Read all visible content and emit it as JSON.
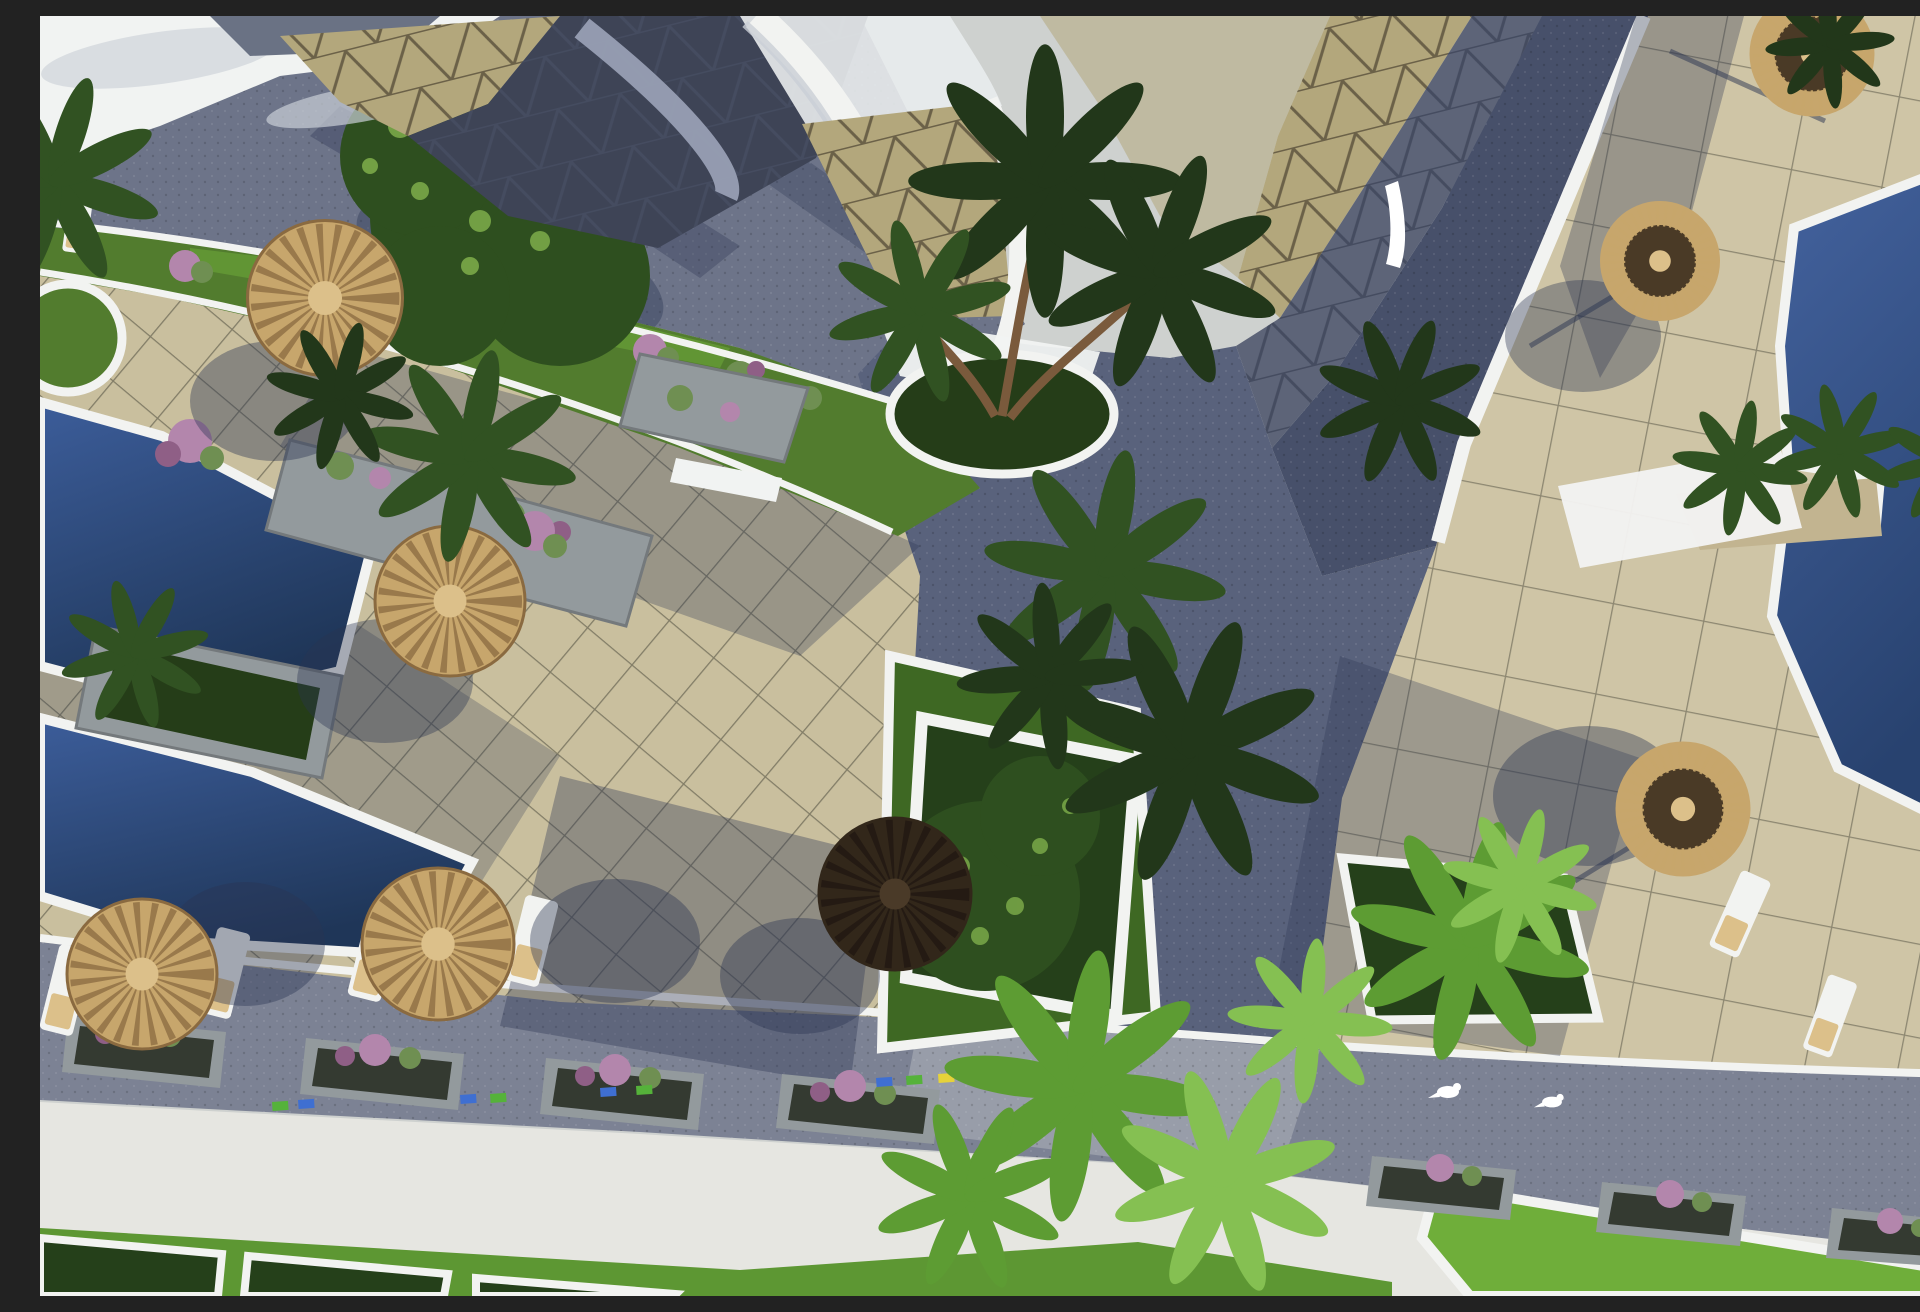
{
  "scene": {
    "type": "3d-architectural-render",
    "view": "aerial",
    "description": "Aerial 3D rendering of a resort pool deck: tiled terraces with thatched straw parasols and sun loungers, three blue swimming pools, curved white building with triangle-patterned roof, palm trees, green planters, flower beds and paved roads",
    "time_of_day": "sunny daylight"
  },
  "colors": {
    "sky": "#ced1cf",
    "terrace": "#c9bf9e",
    "terraceR": "#cfc5a6",
    "roadTL": "#6d7489",
    "roadTR": "#47506a",
    "roadMid": "#59627c",
    "roadBottom": "#7c8294",
    "junction": "#9a9eaa",
    "rim": "#f2f3f1",
    "verge": "#527c2e",
    "lawn": "#5d9733",
    "lawnBright": "#6fae3a",
    "pool": "#1f3658",
    "poolLight": "#3c5d9a",
    "poolR": "#28426f",
    "poolRLight": "#44639f",
    "buildingWhite": "#f1f3f2",
    "buildingShade": "#c9ced6",
    "crescentGray": "#9aa2b6",
    "roofGray": "#6a7284",
    "roofDark2": "#3e4456",
    "roofDarkLine": "#2e3445",
    "roofBeige": "#b3a77c",
    "roofLine": "#6b6148",
    "roofShadowBase": "#5d6478",
    "roofShadowLine": "#454c60",
    "straw": "#c7a66c",
    "strawDark": "#8a6a40",
    "strawLight": "#dcc08a",
    "umbDark": "#32271a",
    "umbDarker": "#201812",
    "umbDarkCenter": "#4a3a28",
    "umbDarkTop": "#4a3a26",
    "stone": "#939a9d",
    "stoneEdge": "#74797c",
    "pebble": "#c2b490",
    "soil": "#253d18",
    "island": "#3e6823",
    "hedge": "#25401a",
    "treeDark": "#2e4f1f",
    "treeLight": "#7fae4b",
    "palmDark": "#22371a",
    "palmMid": "#315222",
    "palmBright": "#5d9c33",
    "palmLight": "#85c052",
    "trunk": "#7a5a3c",
    "flowerPink": "#b386ac",
    "flowerDeep": "#8f5f86",
    "grassTuft": "#6f8f52",
    "shadow": "#2b3552",
    "tickBlue": "#3f6fd1",
    "tickGreen": "#55b23a",
    "tickYellow": "#e6d23a",
    "tickRed": "#bf3a2c",
    "white": "#ffffff"
  },
  "objects": {
    "pools": 3,
    "thatched_parasols": 8,
    "dark_parasol": 1,
    "sun_loungers": 7,
    "palm_tree_clusters": 14,
    "round_tree_canopy": 1,
    "stone_planters": 4,
    "flower_planters_roadside": 7,
    "hedge_planters": 5,
    "grass_island": 1,
    "circular_grass_planter": 1,
    "central_palm_planter": 1,
    "roads": 4,
    "building_with_patterned_roof": 1,
    "white_birds": 2,
    "colored_curb_tiles": 11
  }
}
